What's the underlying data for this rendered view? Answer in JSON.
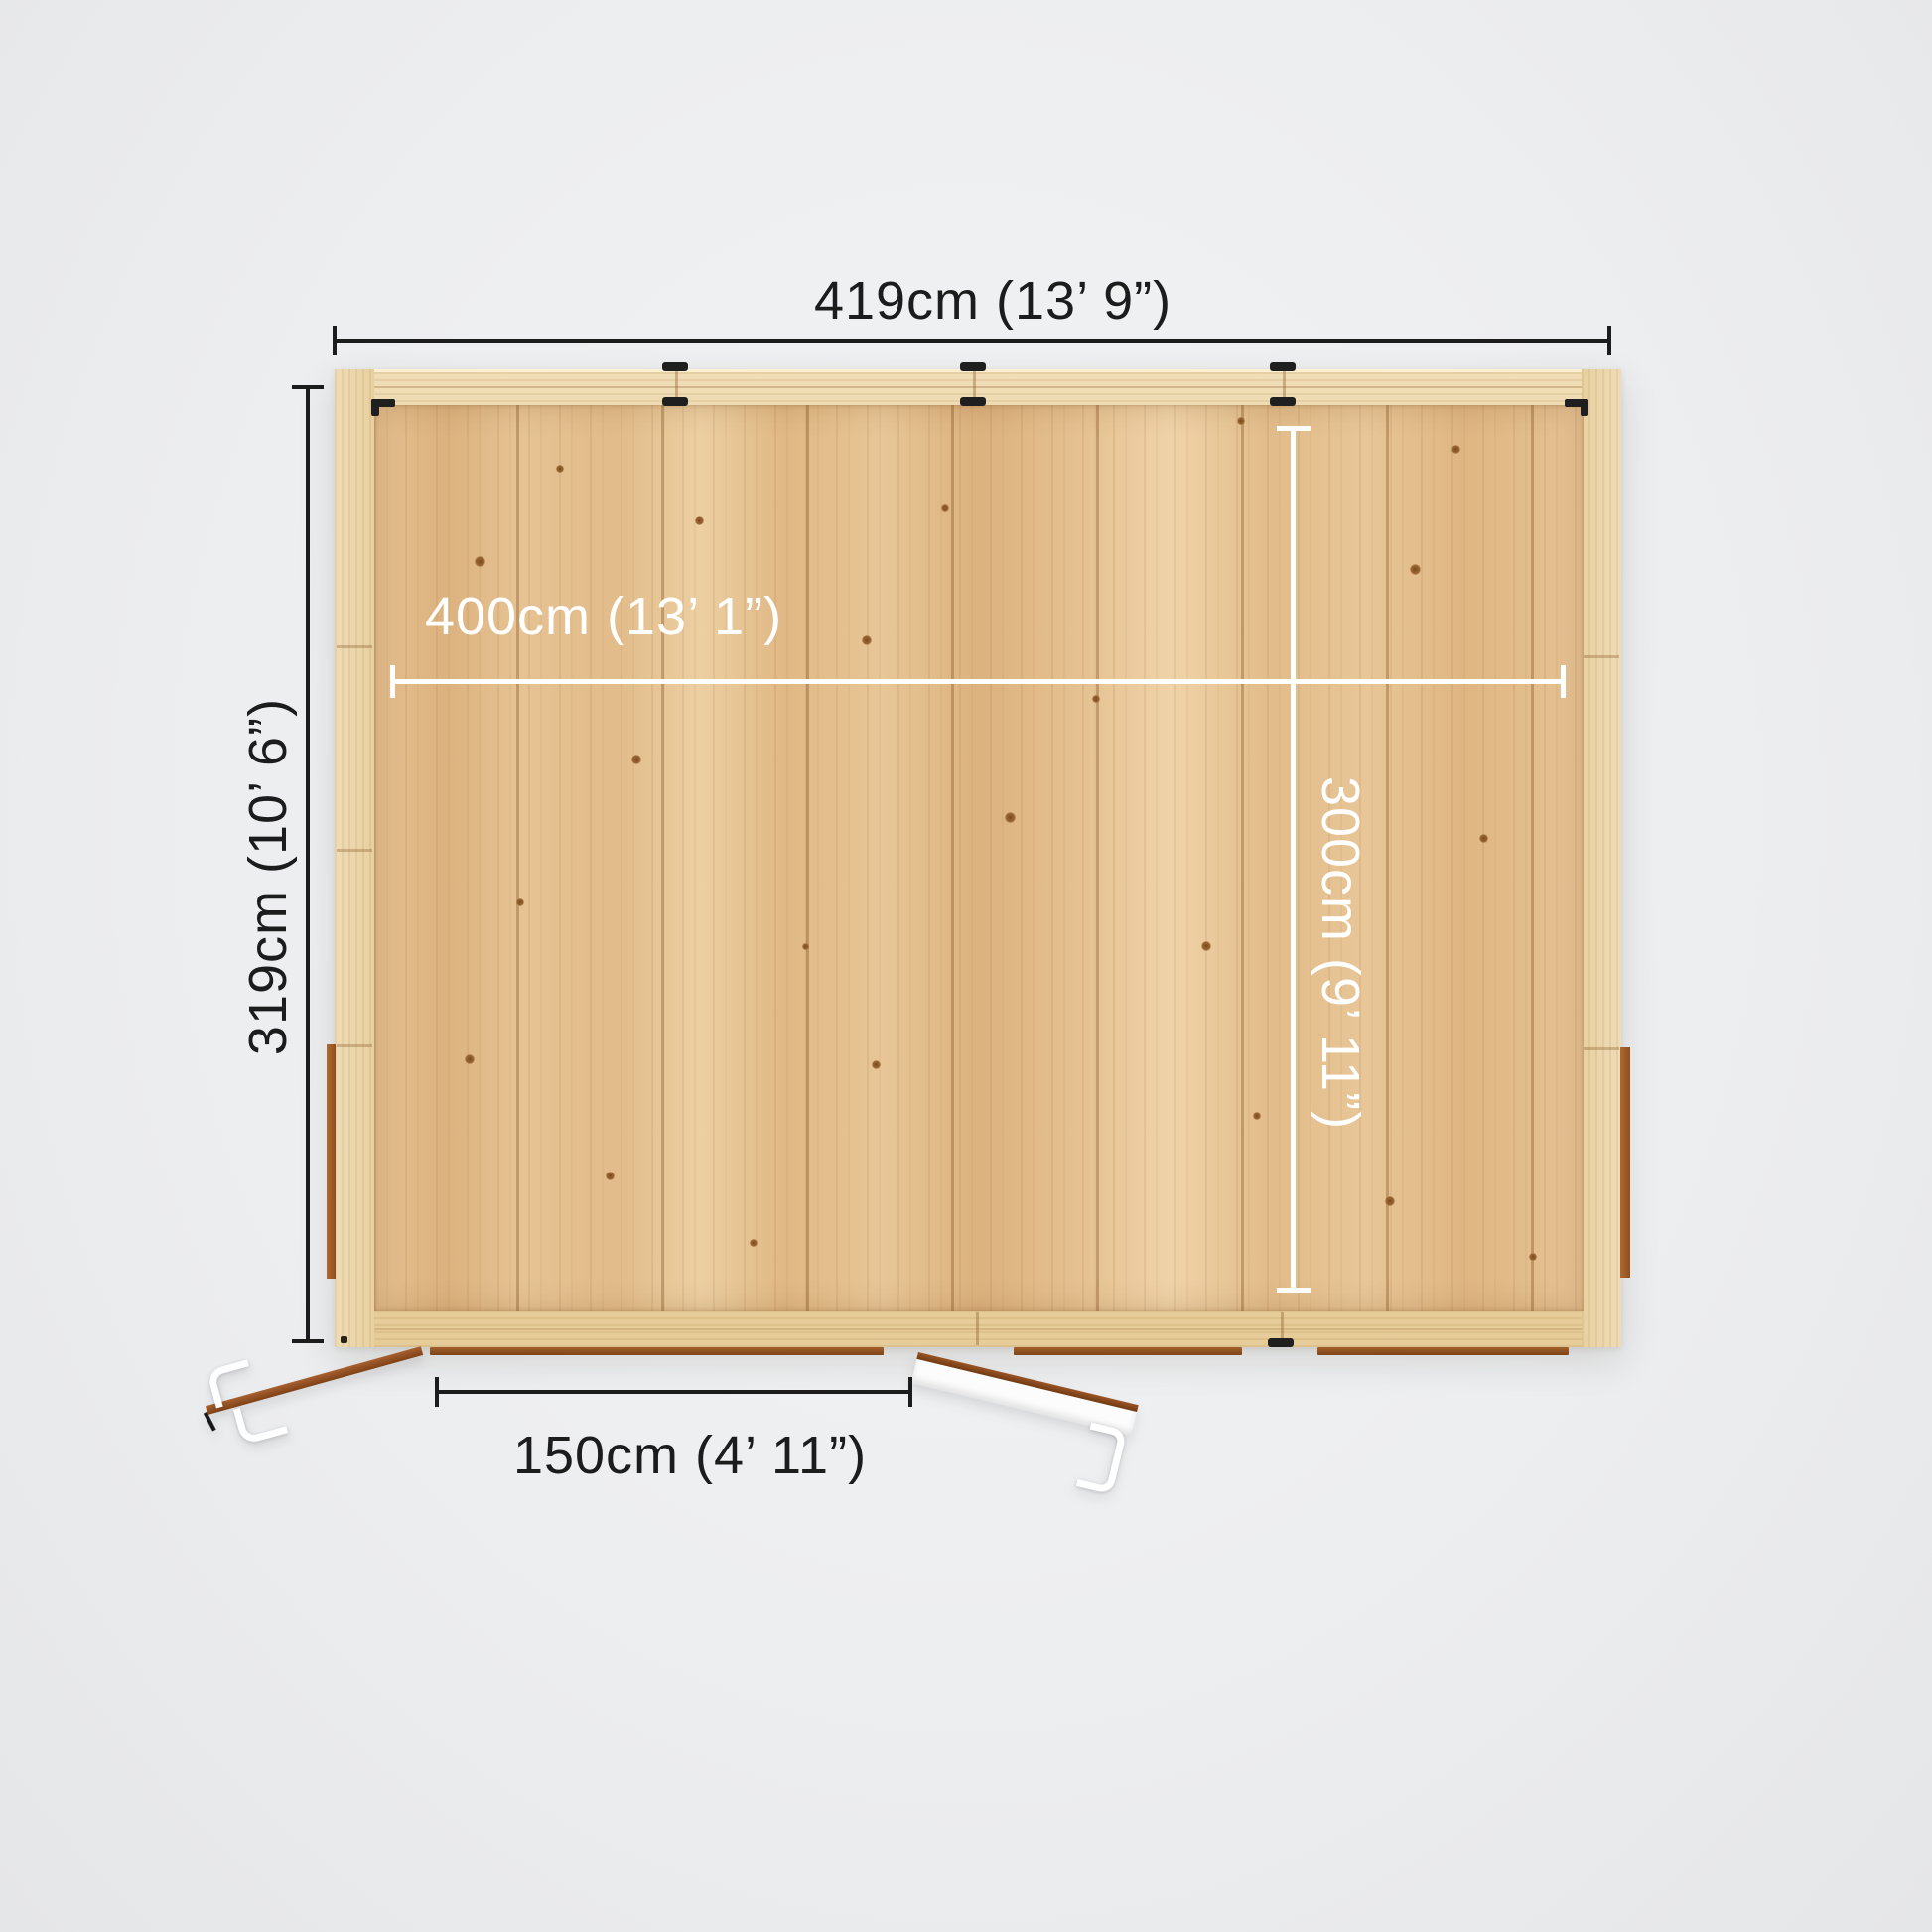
{
  "scene": {
    "title": "Garden log cabin top-down floor plan with dimensions",
    "dimensions": {
      "overall_width": "419cm (13’ 9”)",
      "overall_depth": "319cm (10’ 6”)",
      "internal_width": "400cm (13’ 1”)",
      "internal_depth": "300cm (9’ 11”)",
      "door_opening": "150cm (4’ 11”)"
    },
    "colors": {
      "dim-dark": "#1c1c1c",
      "dim-light": "#ffffff",
      "floor": "#e3bf8e",
      "wall": "#ecd7ad",
      "trim": "#9c5a28",
      "door": "#fcfcfc",
      "clip": "#1f1f1f",
      "bg": "#eef0f1"
    }
  }
}
